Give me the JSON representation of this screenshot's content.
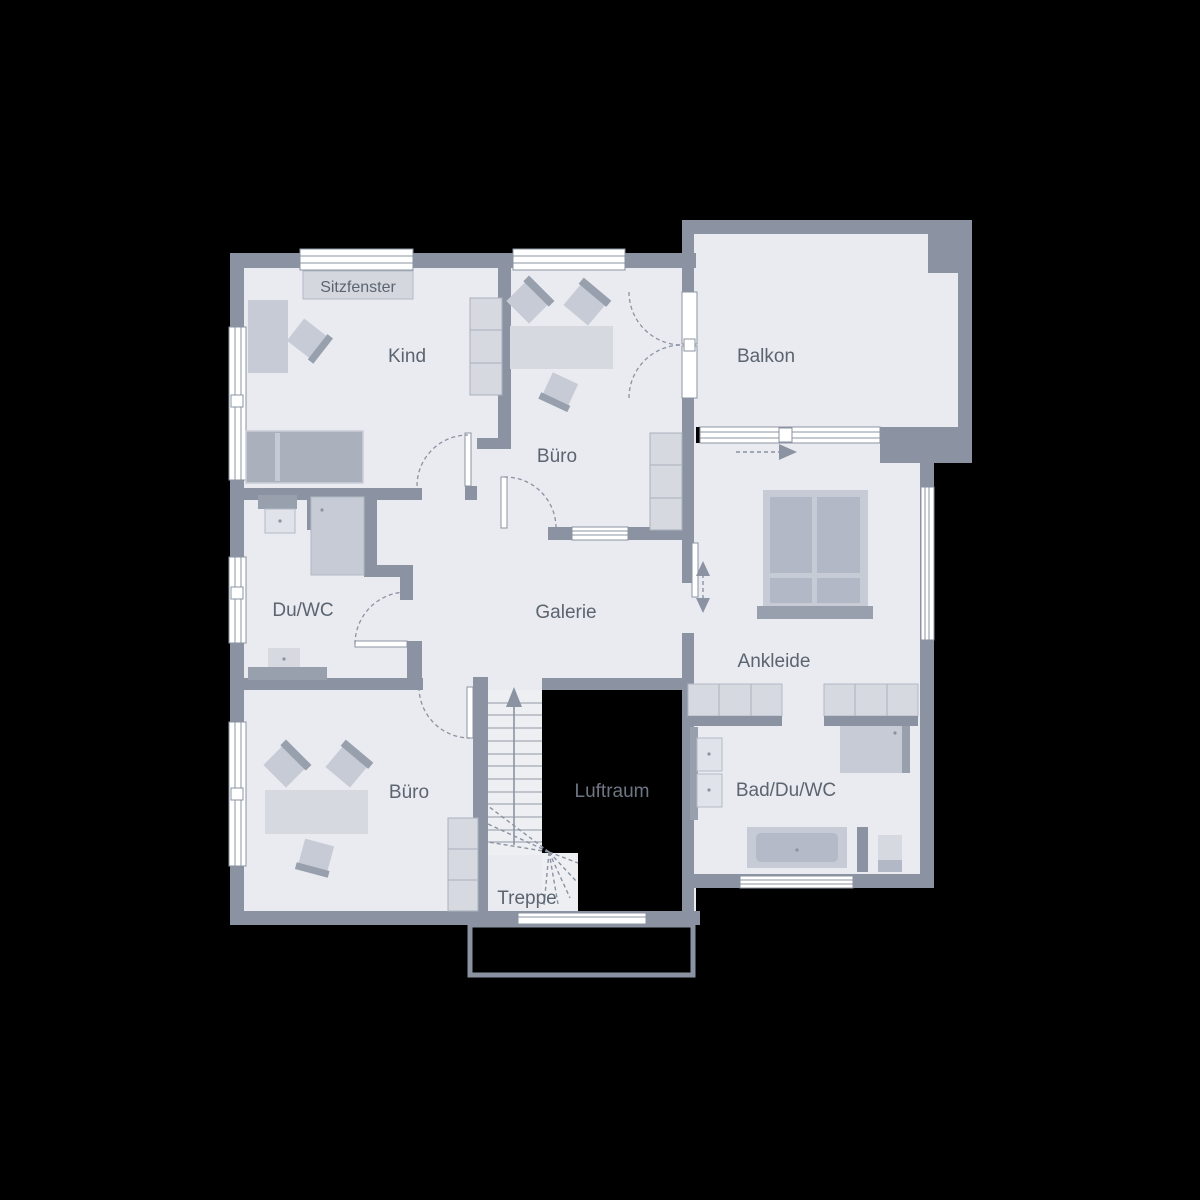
{
  "colors": {
    "background": "#000000",
    "wall": "#8b93a2",
    "floor": "#e9ebf0",
    "furniture_light": "#d6d9e0",
    "furniture_medium": "#c7cbd5",
    "furniture_dark": "#aab0bc",
    "window": "#ffffff",
    "label_text": "#5c6470",
    "void": "#000000"
  },
  "rooms": {
    "kind": "Kind",
    "buero_top": "Büro",
    "balkon": "Balkon",
    "du_wc": "Du/WC",
    "galerie": "Galerie",
    "ankleide": "Ankleide",
    "buero_bottom": "Büro",
    "luftraum": "Luftraum",
    "bad_du_wc": "Bad/Du/WC",
    "treppe": "Treppe"
  },
  "annotations": {
    "sitzfenster": "Sitzfenster"
  }
}
